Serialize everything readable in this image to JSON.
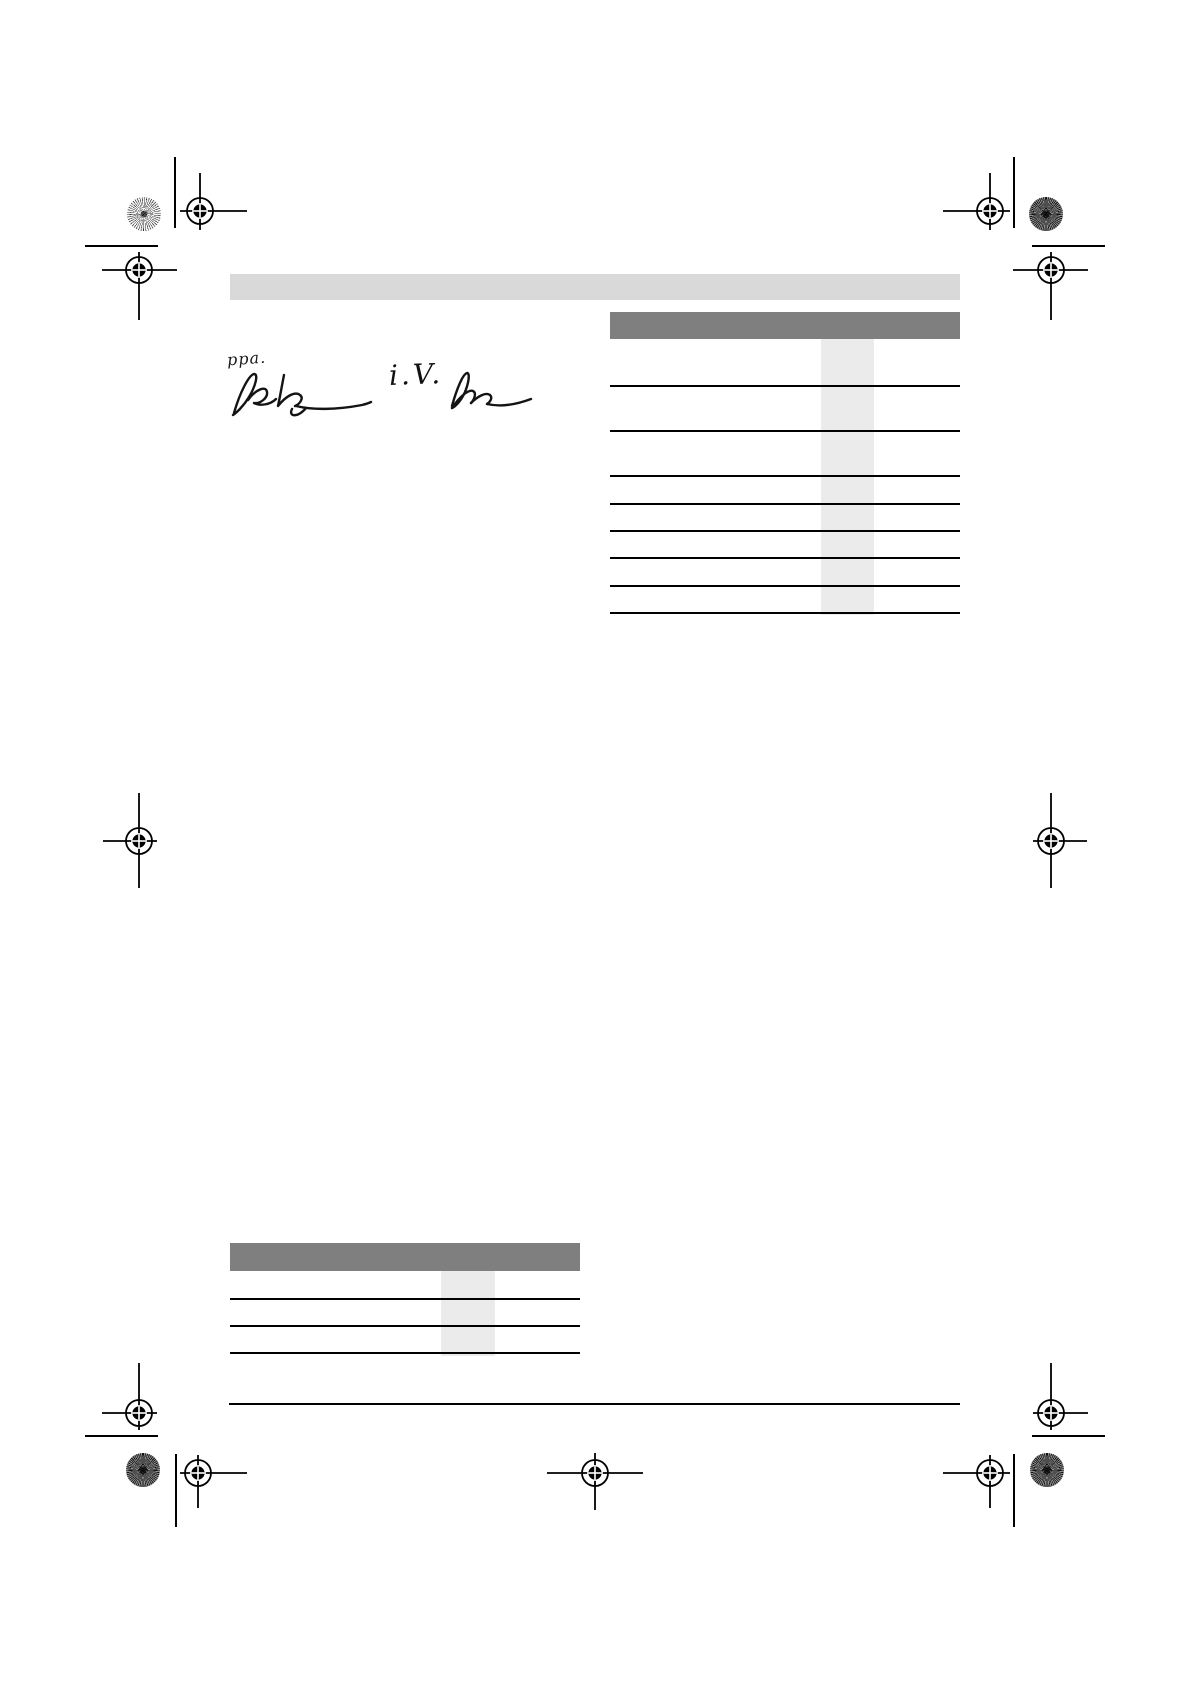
{
  "page": {
    "kind": "scanned-manual-signature-page",
    "background": "#ffffff"
  },
  "colors": {
    "header_band": "#d9d9d9",
    "table_header": "#7f7f7f",
    "column_stripe": "#ebebeb",
    "rule": "#000000"
  },
  "signature": {
    "prefix": "ppa.",
    "proxy_label": "i.V.",
    "signature_count": 2
  },
  "tables": {
    "right": {
      "header_text": "",
      "row_count": 8,
      "highlighted_column": true,
      "cells": []
    },
    "bottom_left": {
      "header_text": "",
      "row_count": 3,
      "highlighted_column": true,
      "cells": []
    }
  },
  "print_marks": {
    "registration_target_count": 11,
    "sunburst_patch_count": 4,
    "crop_line_count": 8,
    "registration_target_icon": "crosshair-in-circle",
    "sunburst_icon": "radial-line-disc",
    "crop_line_icon": "short-rule"
  }
}
